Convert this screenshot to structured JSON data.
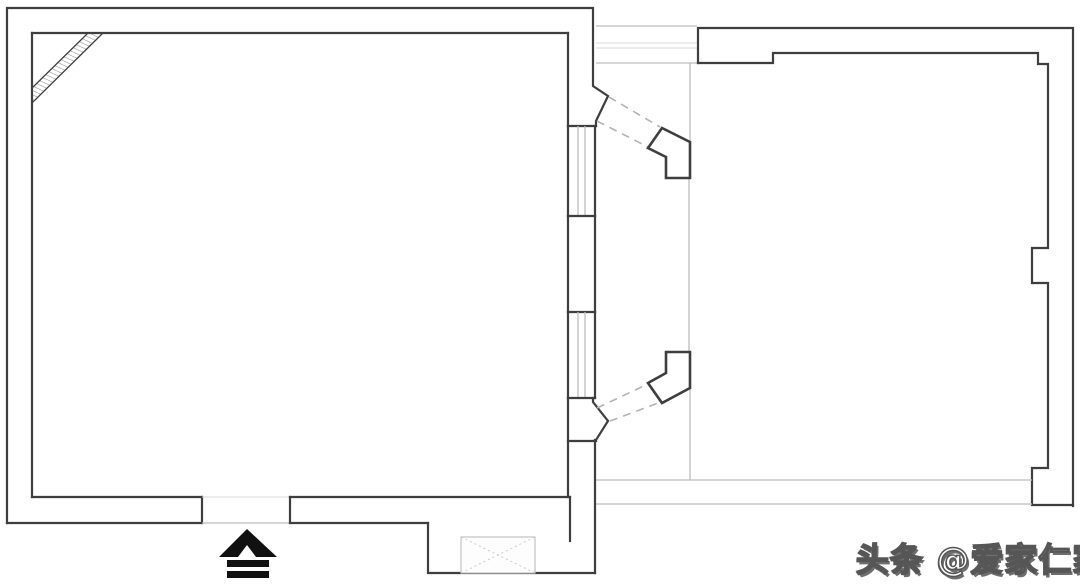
{
  "watermark": {
    "text": "头条 @爱家仁家"
  },
  "plan": {
    "description": "black-and-white architectural floor plan, two rooms joined by an angled doorway passage",
    "colors": {
      "background": "#ffffff",
      "wall": "#3e3e3e",
      "faint": "#bdbdbd",
      "very_faint": "#d9d9d9",
      "dashed": "#b3b3b3",
      "symbol_black": "#111111",
      "watermark_fill": "#ffffff",
      "watermark_outline": "#565656",
      "watermark_shadow": "#6e6e6e"
    },
    "symbols": [
      {
        "name": "entrance-arrow",
        "meaning": "entry direction marker at bottom door opening"
      },
      {
        "name": "shaft-box",
        "meaning": "duct/flue shaft with crossed diagonals in bottom wall bay"
      },
      {
        "name": "corner-flue-hatch",
        "meaning": "hatched diagonal beam strip across top-left room corner"
      },
      {
        "name": "angled-door-piers",
        "meaning": "two angled wall piers with dashed opening lines between rooms"
      },
      {
        "name": "window-band",
        "meaning": "multi-line window symbols on middle wall and top passage"
      }
    ]
  }
}
